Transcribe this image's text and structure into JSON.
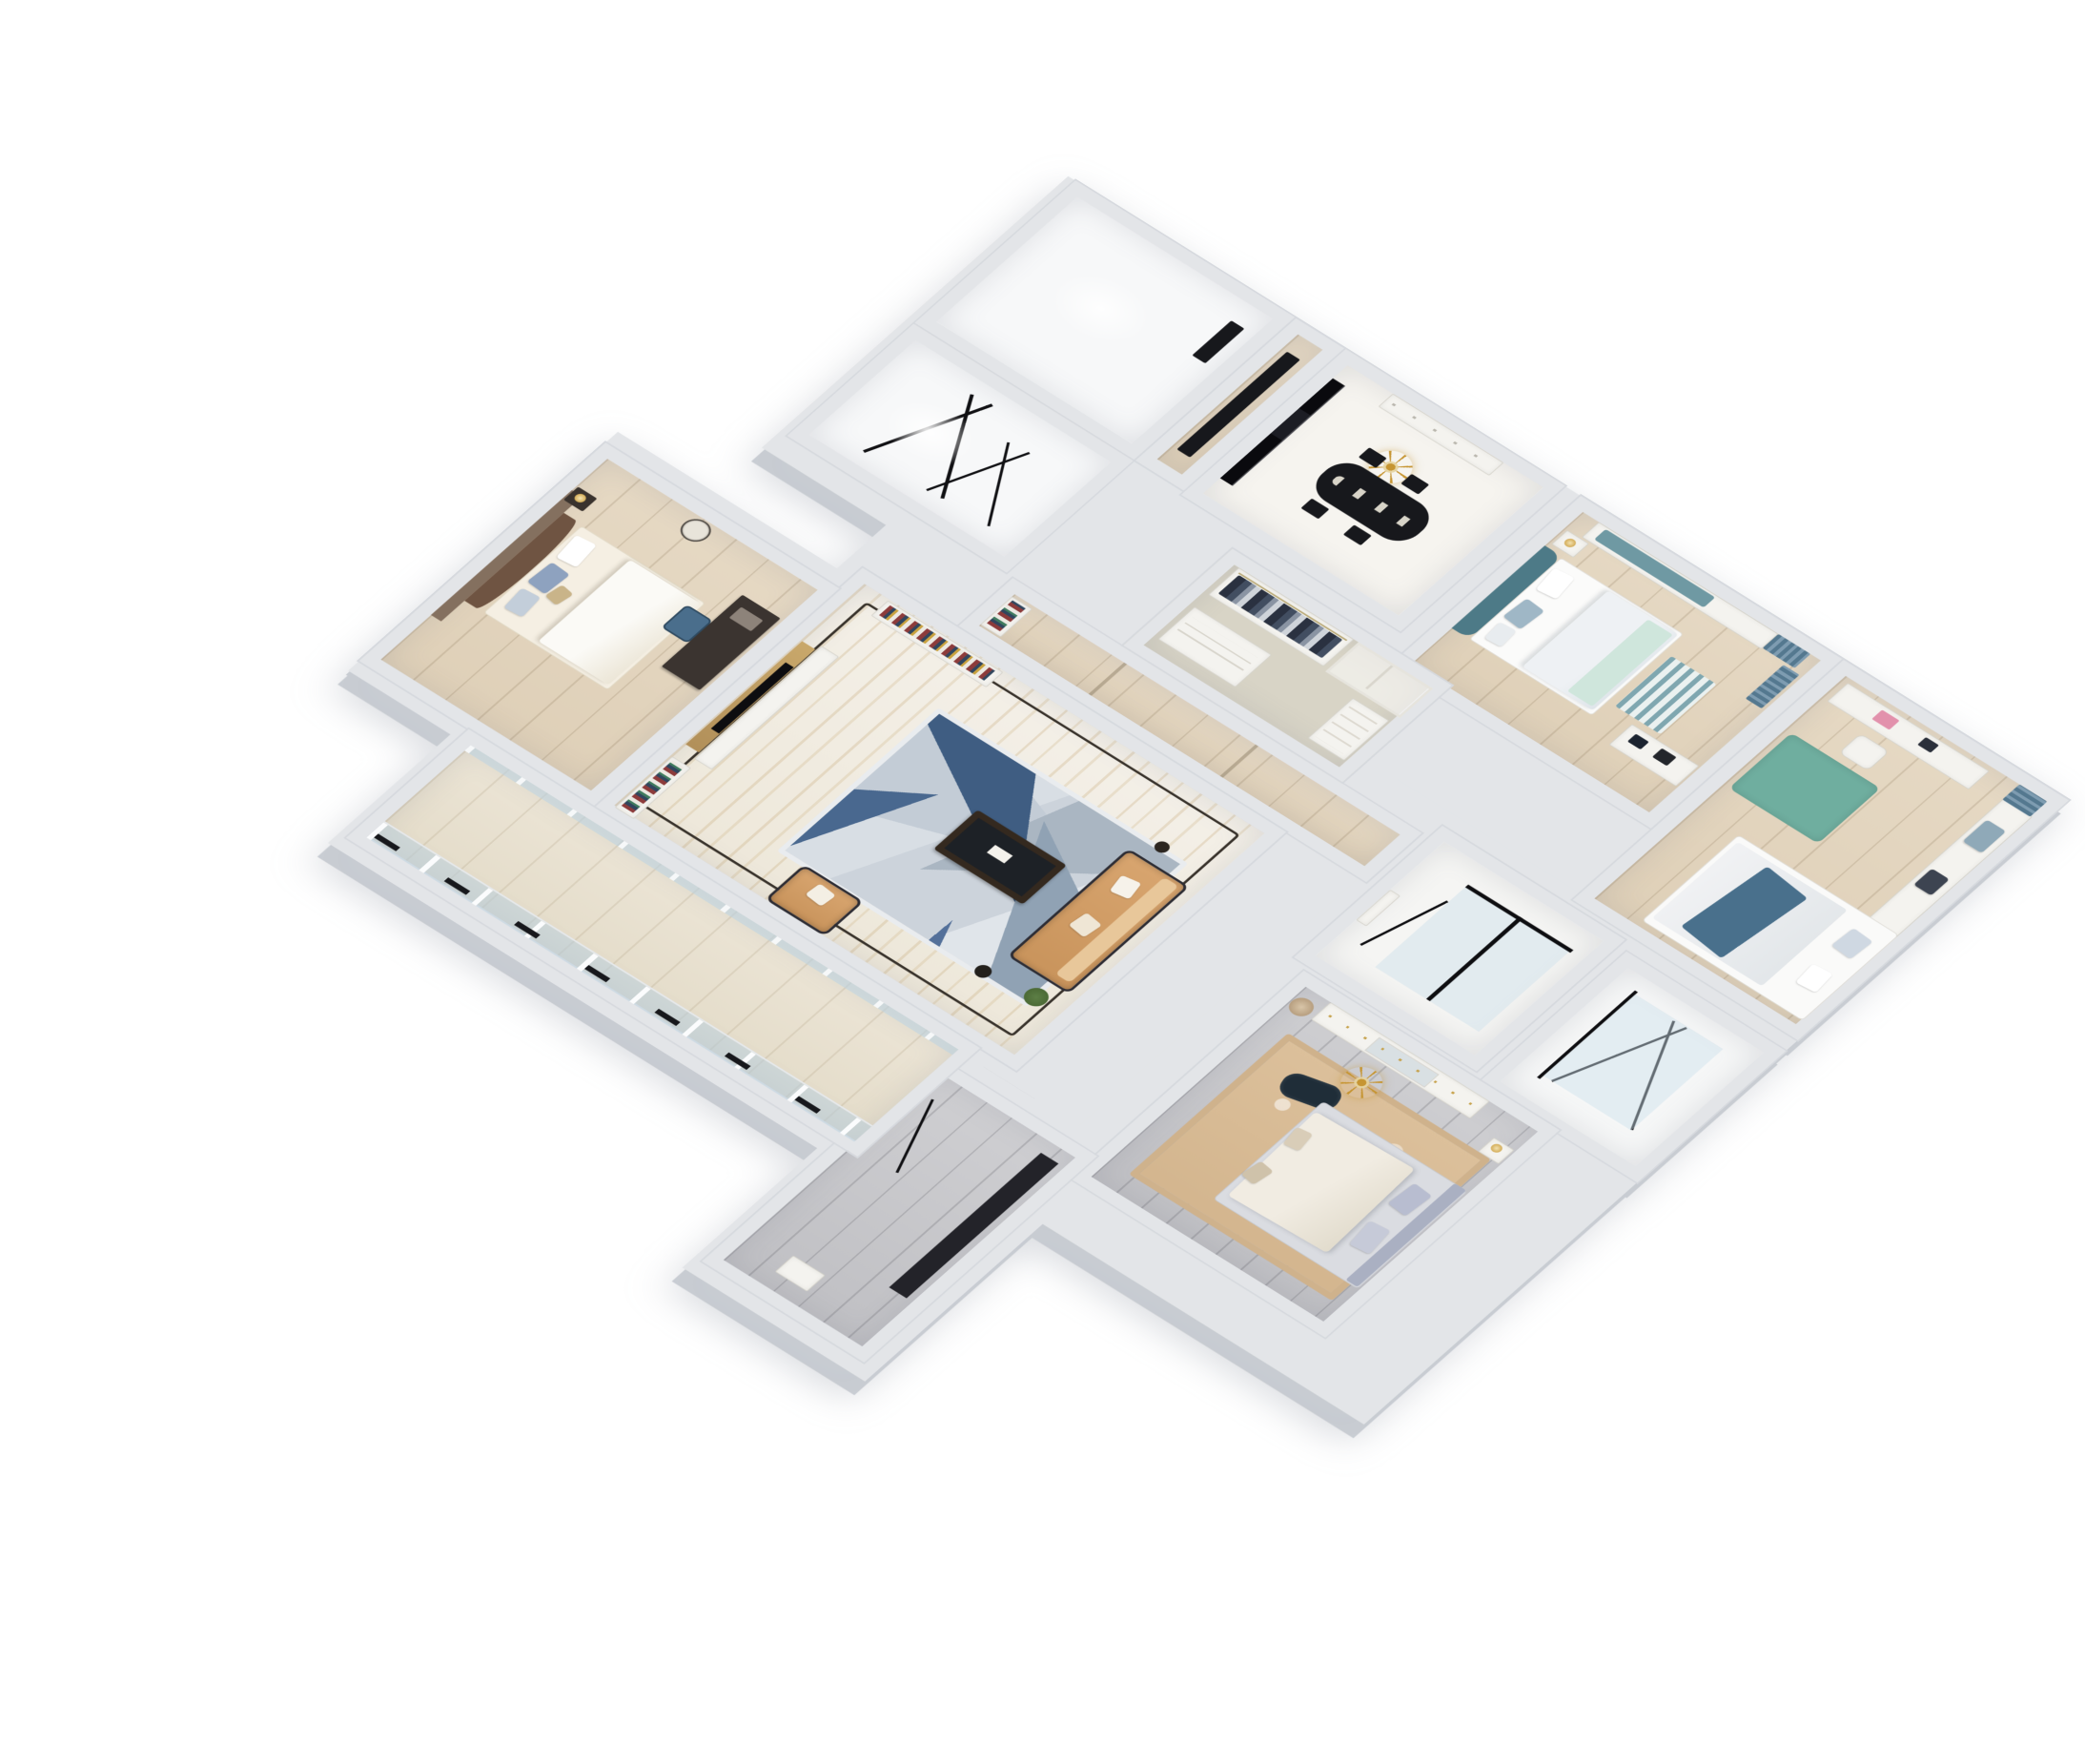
{
  "scene": {
    "title": "3D isometric apartment floor plan render",
    "style": "light-luxury dollhouse cutaway, white background",
    "view": "axonometric top-down, rotated 40 degrees"
  },
  "colors": {
    "wall": "#e3e5e8",
    "wallDark": "#cdd1d6",
    "floorWhite": "#f7f8f9",
    "marbleTone": "#f1ece2",
    "woodTone": "#e3d5c0",
    "grayWood": "#c7c7c9",
    "rugBlue": "#4e6f99",
    "rugGray": "#a7b1bd",
    "sofaTan": "#d8a56f",
    "teal": "#5d8794",
    "curtainBlue": "#54788f",
    "masterRug": "#dcc09b",
    "accentBlack": "#121215",
    "gold": "#c69532",
    "headboardBrown": "#6f5442",
    "greige": "#d8d4c6",
    "glassBlue": "#cddfeb"
  },
  "rooms": [
    {
      "id": "living-room",
      "label": "Living Room",
      "furniture": [
        "tv-wall",
        "media-console",
        "bookshelves",
        "geometric-rug",
        "tan-sofa",
        "armchair",
        "coffee-table",
        "plant",
        "marble-floor-with-dark-trim"
      ]
    },
    {
      "id": "dining-room",
      "label": "Dining Room",
      "furniture": [
        "gold-chandelier",
        "black-dining-table",
        "chairs",
        "sideboard",
        "black-marble-partition"
      ]
    },
    {
      "id": "foyer",
      "label": "Entry Foyer",
      "furniture": [
        "black-runner"
      ]
    },
    {
      "id": "kitchen",
      "label": "Kitchen (unfurnished)",
      "furniture": [
        "dark-doorway"
      ]
    },
    {
      "id": "unfinished-room",
      "label": "Unfinished Room",
      "furniture": [
        "black-sketch-lines"
      ]
    },
    {
      "id": "bay-bedroom",
      "label": "Bedroom with Bay Window",
      "furniture": [
        "teal-bed",
        "bay-window-seat",
        "nightstand",
        "lamp",
        "desk-with-laptop",
        "blue-curtains",
        "striped-rug"
      ]
    },
    {
      "id": "kids-bedroom",
      "label": "Kids Bedroom / Study",
      "furniture": [
        "desk",
        "chair",
        "teal-rug",
        "bed-with-blue-throw",
        "window-seat",
        "blue-curtains"
      ]
    },
    {
      "id": "walk-in-closet",
      "label": "Walk-in Closet",
      "furniture": [
        "hanging-clothes",
        "glass-doors",
        "drawer-unit",
        "shelf-tower"
      ]
    },
    {
      "id": "hallway",
      "label": "Hallway",
      "furniture": [
        "wood-floor",
        "book-niche"
      ]
    },
    {
      "id": "master-bathroom",
      "label": "Master Bathroom",
      "furniture": [
        "black-frame-shower",
        "glass-panel"
      ]
    },
    {
      "id": "second-bathroom",
      "label": "Second Bathroom",
      "furniture": [
        "black-frame-shower-lines"
      ]
    },
    {
      "id": "master-bedroom",
      "label": "Master Bedroom",
      "furniture": [
        "display-cabinet",
        "stool",
        "ornate-tan-rug",
        "gray-bed",
        "dark-ottoman",
        "gold-chandelier",
        "nightstand"
      ]
    },
    {
      "id": "guest-bedroom",
      "label": "Guest Bedroom",
      "furniture": [
        "brown-upholstered-bed",
        "accent-wall",
        "desk",
        "blue-chair",
        "nightstand",
        "round-mirror"
      ]
    },
    {
      "id": "rear-hall",
      "label": "Rear Hall Room",
      "furniture": [
        "dark-runner",
        "seat"
      ]
    },
    {
      "id": "balcony",
      "label": "Balcony",
      "furniture": [
        "wood-deck",
        "glazed-windows",
        "black-railing"
      ]
    }
  ]
}
